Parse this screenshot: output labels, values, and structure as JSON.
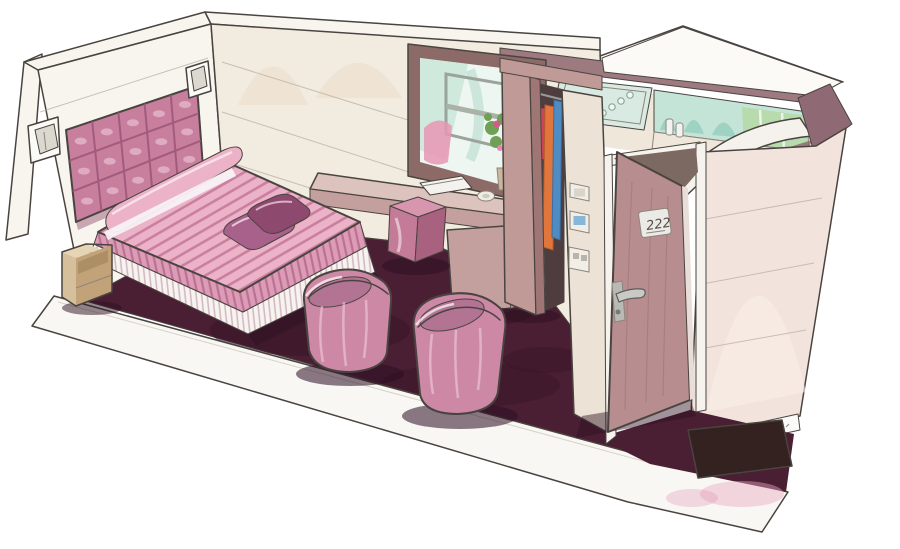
{
  "scene": {
    "description": "Hand-drawn marker and ink concept sketch of a pink hotel guest room shown in cutaway perspective: a double bed with striped pink bedspread and quilted pink headboard flanked by wall sconces and tan nightstands, two pink tub armchairs and a pink cube ottoman on a dark plum carpet, a desk with a book and dish under an interior window with a flower bouquet, an open wardrobe with hanging clothes, a vestibule wall with switch plates, an open entry door with a room number plate, and a bathroom with a mint mirror, toiletries and an arched glass shower screen."
  },
  "door": {
    "plaque_number": "222"
  },
  "palette": {
    "paper": "#ffffff",
    "ink": "#4a4440",
    "wall_cream": "#f1ebe0",
    "wall_white": "#f8f5ef",
    "wall_peach": "#eeddc6",
    "carpet": "#4b1f33",
    "carpet_dark": "#381527",
    "carpet_light": "#5d2940",
    "headboard": "#c87e9d",
    "spread": "#ecb2c8",
    "spread_stripe": "#c9809f",
    "drape": "#dd9cb6",
    "drape_stripe": "#bb7094",
    "skirt": "#f7f3ee",
    "skirt_stripe": "#d4bac6",
    "cushion": "#a7618a",
    "cushion_dark": "#8e4a6e",
    "nightstand_top": "#e6d5b5",
    "nightstand_front": "#d6c09c",
    "nightstand_side": "#c2a379",
    "chair": "#cd88a5",
    "chair_seat": "#b27492",
    "pouf_top": "#d795ae",
    "pouf_front": "#c47b98",
    "pouf_side": "#a86280",
    "desk_top": "#dcc3bd",
    "desk": "#c3a09e",
    "desk_side": "#b18a88",
    "window_frame": "#8c6a68",
    "glass_white": "#eef6f1",
    "glass_mint": "#cfe9dd",
    "reflection_pink": "#e897b4",
    "leaf_green": "#6fa055",
    "flower_pink": "#d45a8c",
    "wood": "#c09a96",
    "wood_dark": "#9f7674",
    "closet_dark": "#4f3c3e",
    "cloth_orange": "#e0763c",
    "cloth_blue": "#4f8cc4",
    "cloth_red": "#cc4455",
    "vestibule_wall": "#ece3d6",
    "switch_plate": "#f1eee8",
    "switch_blue": "#86b7d8",
    "door_face": "#b78d90",
    "door_gap": "#7c6a62",
    "jamb": "#f6f3ee",
    "metal": "#c9c9c6",
    "plaque": "#eceae6",
    "top_band": "#9d7a80",
    "mirror_mint": "#c5e4d8",
    "mirror_teal": "#8ecbb9",
    "glass_green": "#b5d9a8",
    "counter": "#efe7da",
    "dark_panel": "#8f6a74",
    "outer_wall": "#f2e4dd",
    "mat": "#332220",
    "smudge_pink": "#e8a9c4"
  }
}
